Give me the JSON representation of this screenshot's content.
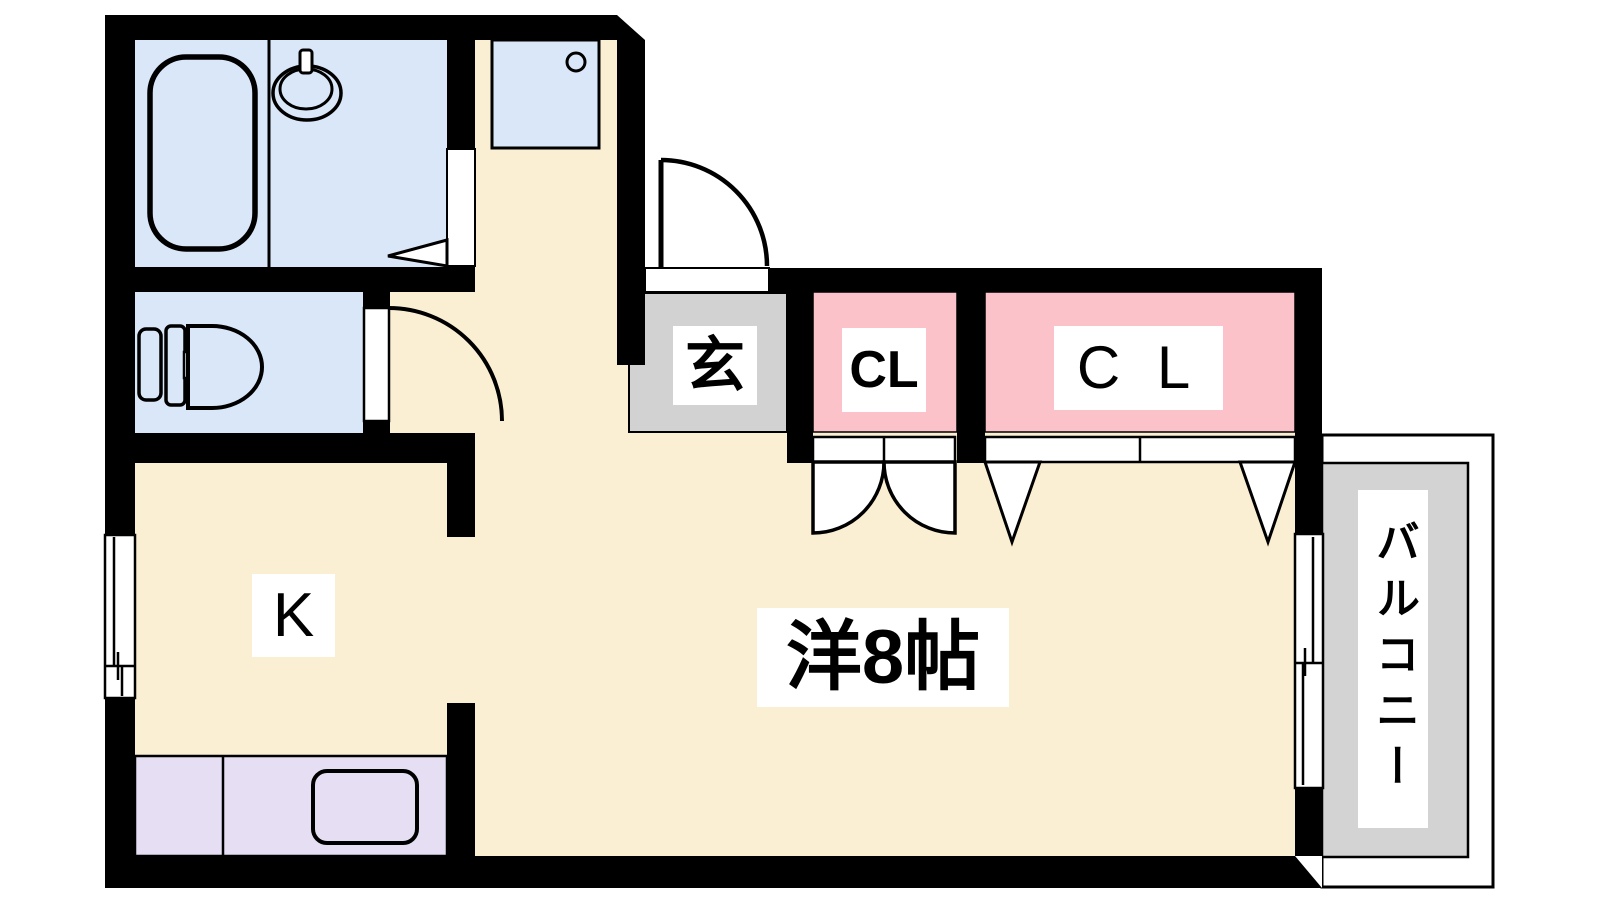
{
  "floorplan": {
    "type": "japanese-apartment-floorplan",
    "labels": {
      "entrance": "玄",
      "closet_small": "CL",
      "closet_large": "C L",
      "kitchen": "K",
      "main_room": "洋8帖",
      "balcony": "バルコニー"
    },
    "colors": {
      "wall": "#000000",
      "floor_cream": "#FBEFD3",
      "wet_area_blue": "#D9E7F8",
      "closet_pink": "#FBC3C9",
      "kitchen_counter_purple": "#E6DEF2",
      "entrance_gray": "#D2D2D2",
      "balcony_gray": "#D3D3D3",
      "label_background": "#FFFFFF",
      "background": "#FFFFFF"
    }
  }
}
